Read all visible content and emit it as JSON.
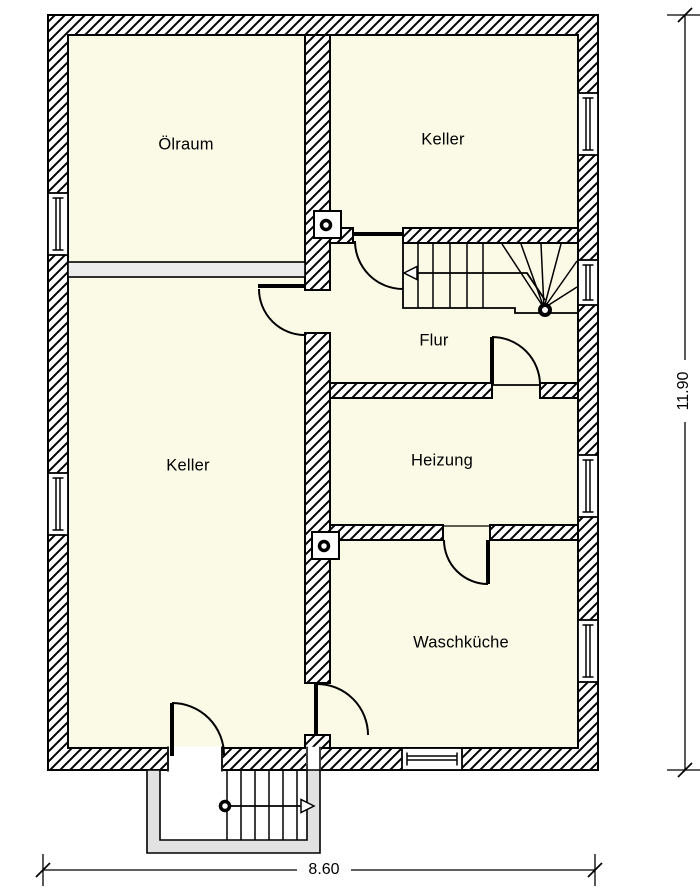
{
  "rooms": [
    {
      "label": "Ölraum"
    },
    {
      "label": "Keller"
    },
    {
      "label": "Flur"
    },
    {
      "label": "Heizung"
    },
    {
      "label": "Keller"
    },
    {
      "label": "Waschküche"
    }
  ],
  "dimensions": {
    "width": "8.60",
    "height": "11.90"
  },
  "colors": {
    "roomFill": "#FBFAE6",
    "partitionFill": "#ECECEC",
    "shaftFill": "#E2E2E2",
    "line": "#000000",
    "background": "#FFFFFF"
  }
}
